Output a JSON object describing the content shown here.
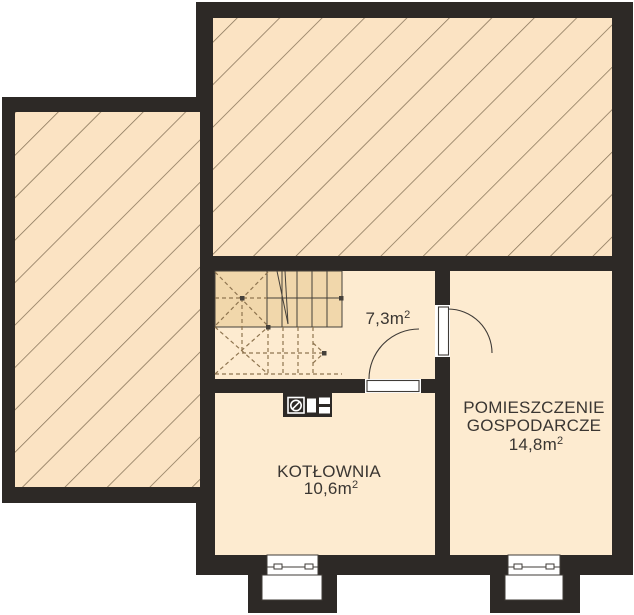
{
  "plan": {
    "kind": "basement floor plan",
    "rooms": {
      "stair_hall": {
        "area": "7,3m²",
        "area_main": "7,3m",
        "area_sup": "2"
      },
      "boiler_room": {
        "name": "KOTŁOWNIA",
        "area": "10,6m²",
        "area_main": "10,6m",
        "area_sup": "2"
      },
      "utility_room": {
        "name_line1": "POMIESZCZENIE",
        "name_line2": "GOSPODARCZE",
        "area": "14,8m²",
        "area_main": "14,8m",
        "area_sup": "2"
      }
    },
    "features": {
      "hatched_zones": 2,
      "doors": 2,
      "windows": 2,
      "light_wells": 2,
      "staircase": 1,
      "boiler_symbol": 1
    }
  },
  "colors": {
    "wall": "#2d2926",
    "floor": "#fdebd0",
    "hatch-bg": "#fbe3c3",
    "hatch-line": "#857257",
    "stair-shade": "#f1d7ab",
    "stair-line": "#45403a",
    "dash": "#8f7550",
    "line": "#3f3b37",
    "text": "#3a3632",
    "white": "#ffffff"
  }
}
